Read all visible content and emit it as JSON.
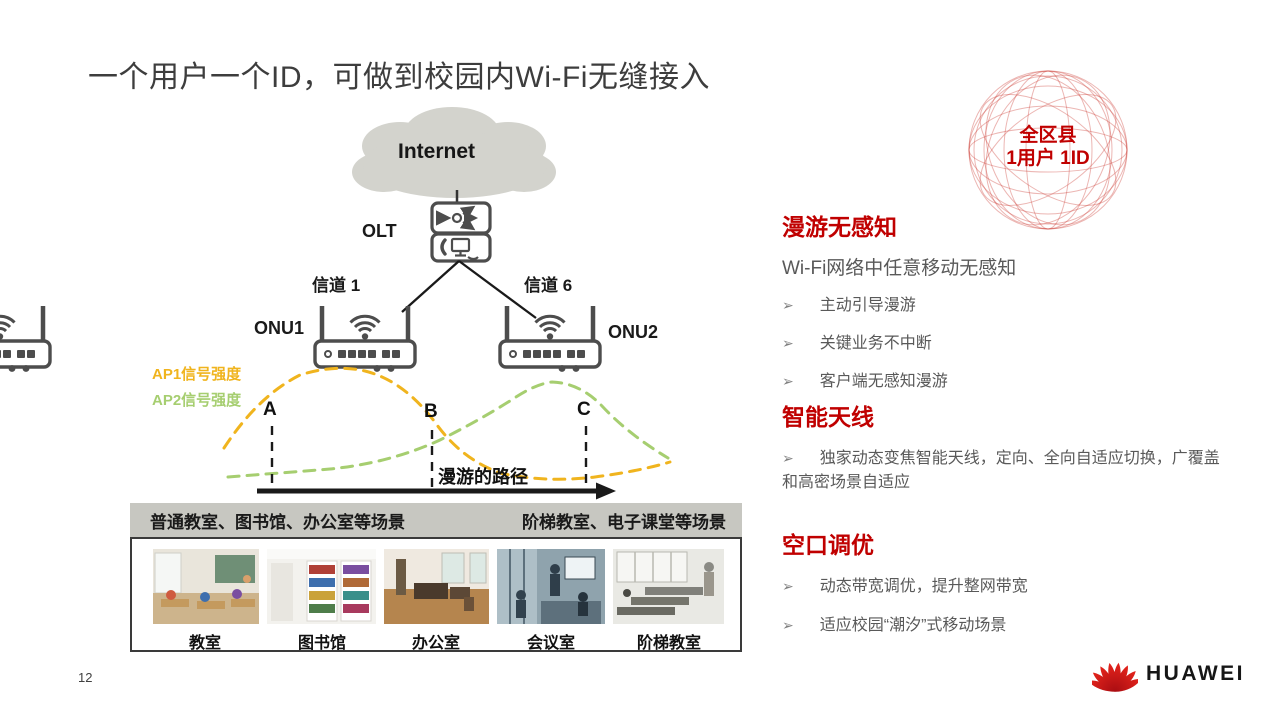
{
  "slide": {
    "title": "一个用户一个ID，可做到校园内Wi-Fi无缝接入",
    "page_number": "12"
  },
  "badge": {
    "line1": "全区县",
    "line2": "1用户 1ID"
  },
  "diagram": {
    "internet": "Internet",
    "olt": "OLT",
    "channel_left": "信道 1",
    "channel_right": "信道 6",
    "onu_left": "ONU1",
    "onu_right": "ONU2",
    "legend_ap1": "AP1信号强度",
    "legend_ap2": "AP2信号强度",
    "point_a": "A",
    "point_b": "B",
    "point_c": "C",
    "roam_path": "漫游的路径",
    "banner_left": "普通教室、图书馆、办公室等场景",
    "banner_right": "阶梯教室、电子课堂等场景",
    "photos": [
      {
        "label": "教室"
      },
      {
        "label": "图书馆"
      },
      {
        "label": "办公室"
      },
      {
        "label": "会议室"
      },
      {
        "label": "阶梯教室"
      }
    ]
  },
  "sections": [
    {
      "heading": "漫游无感知",
      "subtitle": "Wi-Fi网络中任意移动无感知",
      "bullets": [
        "主动引导漫游",
        "关键业务不中断",
        "客户端无感知漫游"
      ]
    },
    {
      "heading": "智能天线",
      "bullets": [
        "独家动态变焦智能天线，定向、全向自适应切换，广覆盖和高密场景自适应"
      ]
    },
    {
      "heading": "空口调优",
      "bullets": [
        "动态带宽调优，提升整网带宽",
        "适应校园“潮汐”式移动场景"
      ]
    }
  ],
  "logo": {
    "brand": "HUAWEI"
  },
  "icons": {
    "bullet_arrow": "➢"
  },
  "colors": {
    "accent_red": "#C00000",
    "ap1_signal_yellow": "#F0B41E",
    "ap2_signal_green": "#A6CE70",
    "banner_gray": "#C7C7C1",
    "device_gray": "#4D4D4D",
    "cloud_gray": "#D3D3CD",
    "huawei_red": "#CE0A1E"
  }
}
